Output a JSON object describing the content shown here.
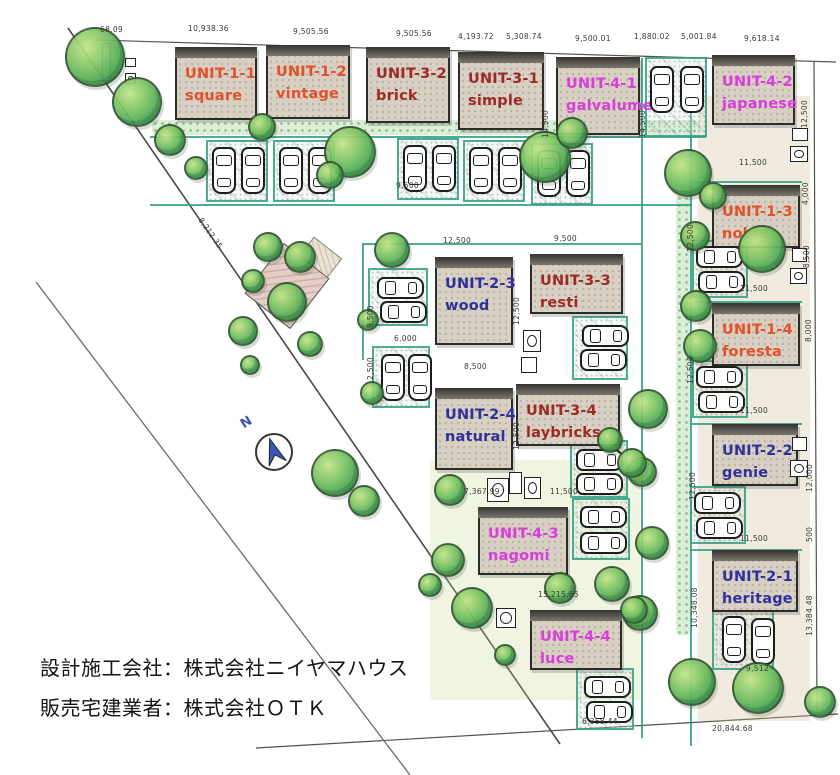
{
  "legend": {
    "line1": "設計施工会社：株式会社ニイヤマハウス",
    "line2": "販売宅建業者：株式会社ＯＴＫ"
  },
  "compass": {
    "label": "N"
  },
  "colors": {
    "series_1_red": "#e2512a",
    "series_2_navy": "#31309b",
    "series_3_maroon": "#9e2a28",
    "series_4_magenta": "#d93ddb",
    "parking_line_teal": "#2f9f82",
    "unit_fill": "#d8d0c3",
    "tree_green": "#3f9e4f"
  },
  "units": [
    {
      "id": "UNIT-1-1",
      "name": "square",
      "series": 1
    },
    {
      "id": "UNIT-1-2",
      "name": "vintage",
      "series": 1
    },
    {
      "id": "UNIT-3-2",
      "name": "brick",
      "series": 3
    },
    {
      "id": "UNIT-3-1",
      "name": "simple",
      "series": 3
    },
    {
      "id": "UNIT-4-1",
      "name": "galvalume",
      "series": 4
    },
    {
      "id": "UNIT-4-2",
      "name": "japanese",
      "series": 4
    },
    {
      "id": "UNIT-1-3",
      "name": "noble",
      "series": 1
    },
    {
      "id": "UNIT-1-4",
      "name": "foresta",
      "series": 1
    },
    {
      "id": "UNIT-2-2",
      "name": "genie",
      "series": 2
    },
    {
      "id": "UNIT-2-1",
      "name": "heritage",
      "series": 2
    },
    {
      "id": "UNIT-2-3",
      "name": "wood",
      "series": 2
    },
    {
      "id": "UNIT-3-3",
      "name": "resti",
      "series": 3
    },
    {
      "id": "UNIT-2-4",
      "name": "natural",
      "series": 2
    },
    {
      "id": "UNIT-3-4",
      "name": "laybricks",
      "series": 3
    },
    {
      "id": "UNIT-4-3",
      "name": "nagomi",
      "series": 4
    },
    {
      "id": "UNIT-4-4",
      "name": "luce",
      "series": 4
    }
  ],
  "dimensions": [
    "68.09",
    "10,938.36",
    "9,505.56",
    "9,505.56",
    "4,193.72",
    "5,308.74",
    "9,500.01",
    "1,880.02",
    "5,001.84",
    "9,618.14",
    "12,500",
    "4,000",
    "8,500",
    "8,000",
    "12,000",
    "500",
    "13,384.48",
    "11,500",
    "11,500",
    "11,500",
    "11,500",
    "12,500",
    "12,500",
    "12,500",
    "10,348.08",
    "12,500",
    "9,500",
    "12,500",
    "12,500",
    "8,500",
    "2,500",
    "6,000",
    "8,500",
    "14,500",
    "14,500",
    "7,367.99",
    "11,500",
    "15,215.65",
    "6,368.44",
    "9,512",
    "20,844.68",
    "8,212.35",
    "9,500"
  ]
}
